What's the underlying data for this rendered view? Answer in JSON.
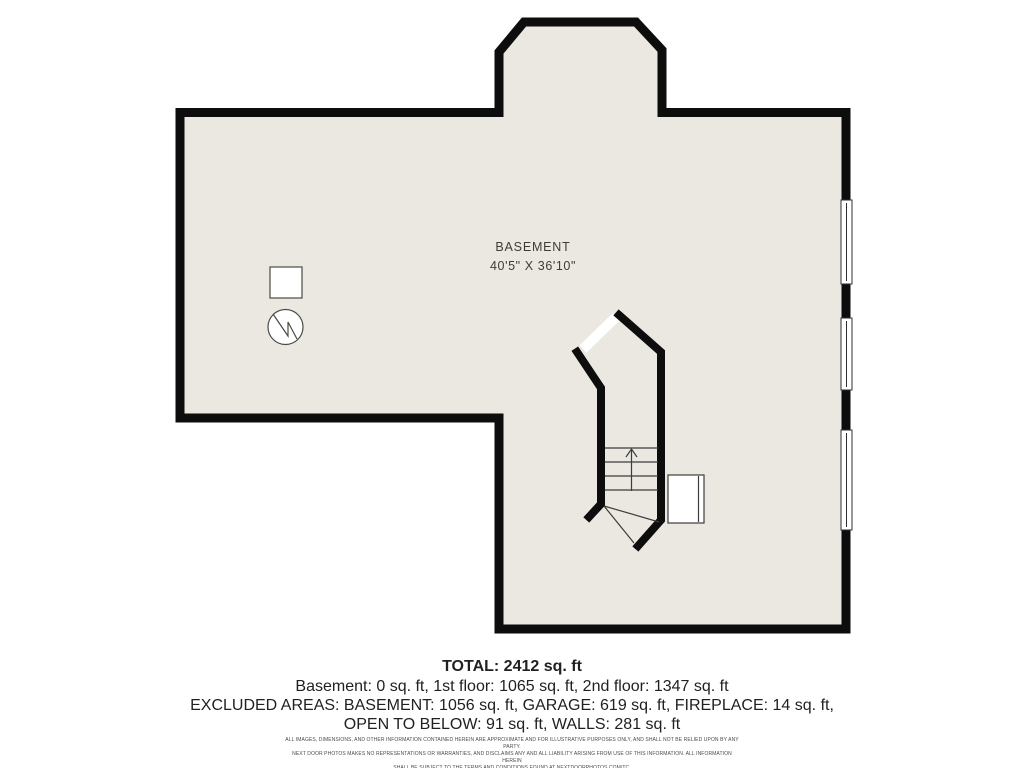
{
  "plan": {
    "room_label": "BASEMENT",
    "room_dimensions": "40'5\" X 36'10\"",
    "colors": {
      "floor": "#eae8e0",
      "wall": "#0d0d0d",
      "background": "#ffffff",
      "symbol_stroke": "#4a4a44",
      "tread_stroke": "#3c3c3c"
    },
    "symbols": [
      "utility-square",
      "water-heater-circle-zigzag",
      "staircase-up",
      "stair-landing-rectangle",
      "window-top",
      "window-middle",
      "window-bottom"
    ]
  },
  "summary": {
    "total": "TOTAL: 2412 sq. ft",
    "floors": "Basement: 0 sq. ft, 1st floor: 1065 sq. ft, 2nd floor: 1347 sq. ft",
    "excluded_line1": "EXCLUDED AREAS: BASEMENT: 1056 sq. ft, GARAGE: 619 sq. ft, FIREPLACE: 14 sq. ft,",
    "excluded_line2": "OPEN TO BELOW: 91 sq. ft, WALLS: 281 sq. ft"
  },
  "disclaimer": {
    "line1": "ALL IMAGES, DIMENSIONS, AND OTHER INFORMATION CONTAINED HEREIN ARE APPROXIMATE AND FOR ILLUSTRATIVE PURPOSES ONLY, AND SHALL NOT BE RELIED UPON BY ANY PARTY.",
    "line2": "NEXT DOOR PHOTOS MAKES NO REPRESENTATIONS OR WARRANTIES, AND DISCLAIMS ANY AND ALL LIABILITY ARISING FROM USE OF THIS INFORMATION. ALL INFORMATION HEREIN",
    "line3": "SHALL BE SUBJECT TO THE TERMS AND CONDITIONS FOUND AT NEXTDOORPHOTOS.COM/TC."
  }
}
